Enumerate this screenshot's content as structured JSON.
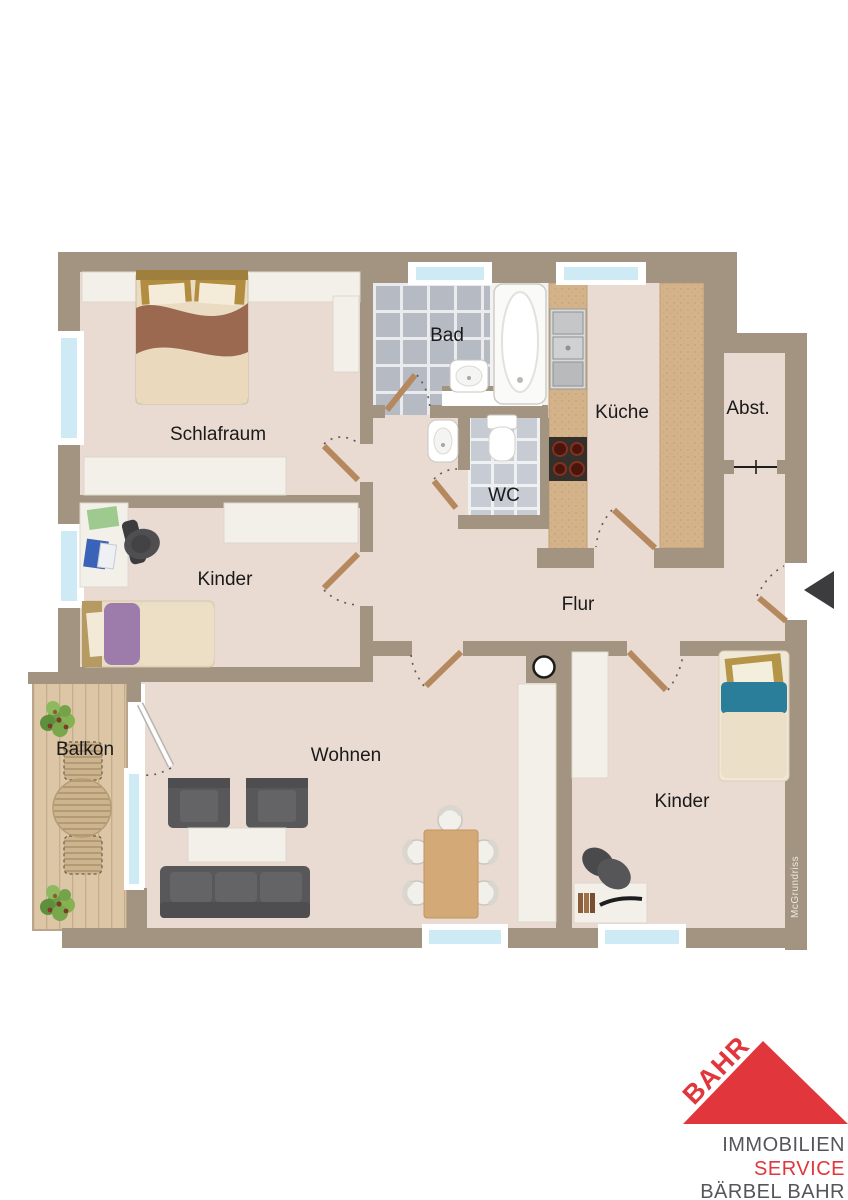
{
  "plan": {
    "rooms": {
      "schlafraum": {
        "label": "Schlafraum"
      },
      "bad": {
        "label": "Bad"
      },
      "wc": {
        "label": "WC"
      },
      "kueche": {
        "label": "Küche"
      },
      "abstellraum": {
        "label": "Abst."
      },
      "flur": {
        "label": "Flur"
      },
      "kinder1": {
        "label": "Kinder"
      },
      "wohnen": {
        "label": "Wohnen"
      },
      "kinder2": {
        "label": "Kinder"
      },
      "balkon": {
        "label": "Balkon"
      }
    },
    "watermark": "McGrundriss"
  },
  "logo": {
    "roof_text": "BAHR",
    "line1": "IMMOBILIEN",
    "line2": "SERVICE",
    "line3": "BÄRBEL BAHR"
  },
  "colors": {
    "wall": "#a29480",
    "floor": "#e9dad2",
    "tile-bad": "#b6bbc3",
    "tile-wc": "#c7ccd4",
    "glass": "#cdeaf5",
    "frame": "#ffffff",
    "wood-balcony": "#dcc6a6",
    "plank-line": "#c5ae8d",
    "counter": "#d4b28a",
    "door": "#b5885e",
    "dark-furniture": "#58585a",
    "white-furniture": "#f3f0e9",
    "blanket-brown": "#9b6850",
    "blanket-purple": "#9d7bab",
    "blanket-teal": "#2b7e99",
    "table-wood": "#d2a977",
    "plant-green": "#76a24a",
    "logo-red": "#e0363c",
    "logo-gray": "#55565a",
    "arrow": "#3c3c3e",
    "label": "#1a1a1a",
    "watermark": "#ece8e0"
  }
}
